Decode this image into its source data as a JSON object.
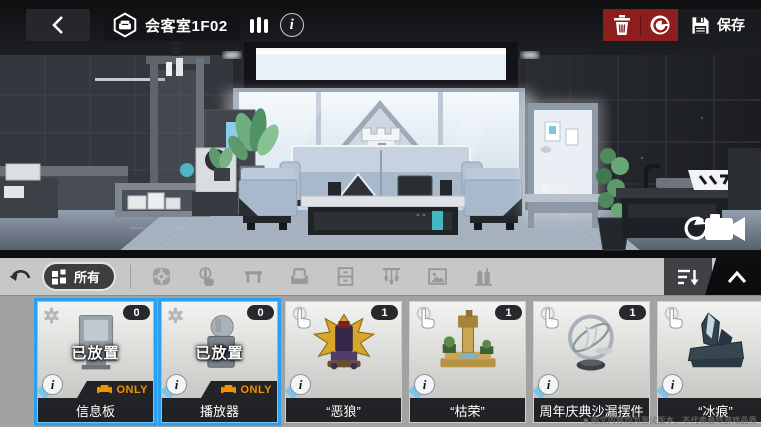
{
  "header": {
    "room_title": "会客室1F02",
    "save_label": "保存",
    "icons": [
      "back-chevron-icon",
      "room-hexagon-sofa-icon",
      "comfort-bars-icon",
      "info-icon",
      "trash-icon",
      "reset-icon",
      "save-floppy-icon"
    ]
  },
  "toolbar": {
    "all_label": "所有",
    "icons": [
      "undo-icon",
      "grid-all-icon",
      "function-gear-icon",
      "tap-interact-icon",
      "table-icon",
      "seat-icon",
      "cabinet-icon",
      "ceiling-light-icon",
      "picture-icon",
      "theme-building-icon",
      "sort-icon",
      "collapse-up-icon"
    ]
  },
  "scene_icons": [
    "camera-reset-icon",
    "triangle-rook-logo"
  ],
  "items": [
    {
      "name": "信息板",
      "count": "0",
      "status": "已放置",
      "only_label": "ONLY",
      "selected": true,
      "corner_icon": "gear-icon",
      "art": "board"
    },
    {
      "name": "播放器",
      "count": "0",
      "status": "已放置",
      "only_label": "ONLY",
      "selected": true,
      "corner_icon": "gear-icon",
      "art": "player"
    },
    {
      "name": "“恶狼”",
      "count": "1",
      "status": "",
      "only_label": "",
      "selected": false,
      "corner_icon": "tap-icon",
      "art": "throne"
    },
    {
      "name": "“枯荣”",
      "count": "1",
      "status": "",
      "only_label": "",
      "selected": false,
      "corner_icon": "tap-icon",
      "art": "bonsai"
    },
    {
      "name": "周年庆典沙漏摆件",
      "count": "1",
      "status": "",
      "only_label": "",
      "selected": false,
      "corner_icon": "tap-icon",
      "art": "hourglass"
    },
    {
      "name": "“冰痕”",
      "count": null,
      "status": "",
      "only_label": "",
      "selected": false,
      "corner_icon": "tap-icon",
      "art": "ice"
    }
  ],
  "watermark": "■ 图文内容均为测试版本，不代表最终游戏品质",
  "colors": {
    "accent_blue": "#2aa0f2",
    "badge_orange": "#f29200",
    "danger_red": "#8e1d1d",
    "toolbar_gray": "#c7c7c7"
  }
}
